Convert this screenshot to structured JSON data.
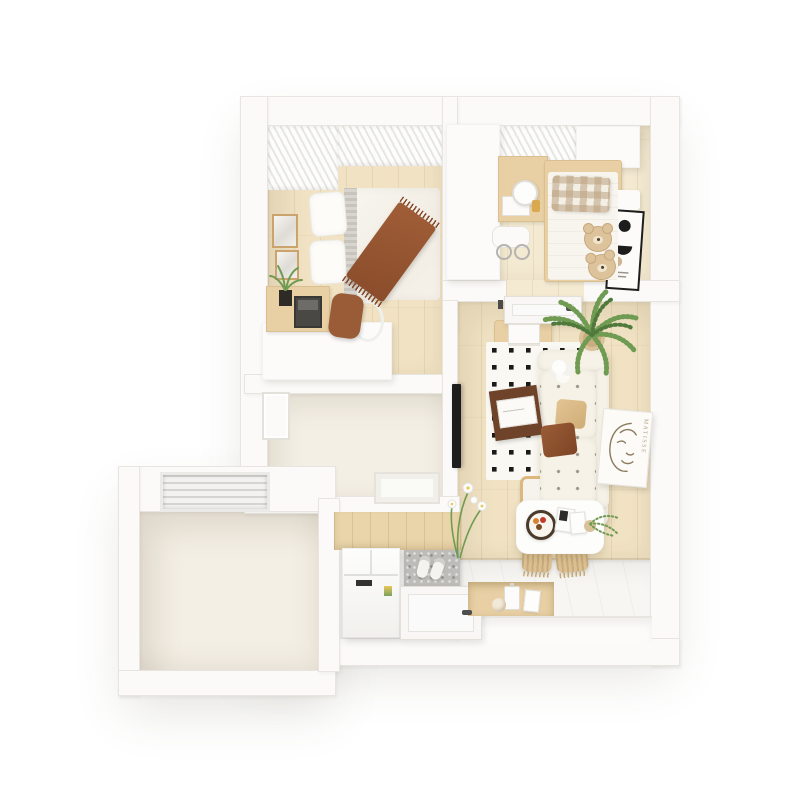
{
  "scene": {
    "poster_text": "MATISSE"
  },
  "palette": {
    "wall": "#fbfaf8",
    "wall_edge": "#e8e5e0",
    "floor_wood": "#f0e2c3",
    "floor_wood_light": "#f4ead2",
    "floor_cream": "#f4efe5",
    "floor_white": "#f7f6f3",
    "wood_furniture": "#e8d0a4",
    "rug_bg": "#faf8f3",
    "rug_dot": "#1a1a1a",
    "sofa": "#f3eee1",
    "throw_brown": "#a05e37",
    "chair_brown": "#9a5c36",
    "teddy": "#dcc39c",
    "plant_green": "#6f9b52",
    "plant_dark": "#4f7a3c",
    "mat_gray": "#bdbcb8",
    "frame_black": "#1d1d1d"
  }
}
